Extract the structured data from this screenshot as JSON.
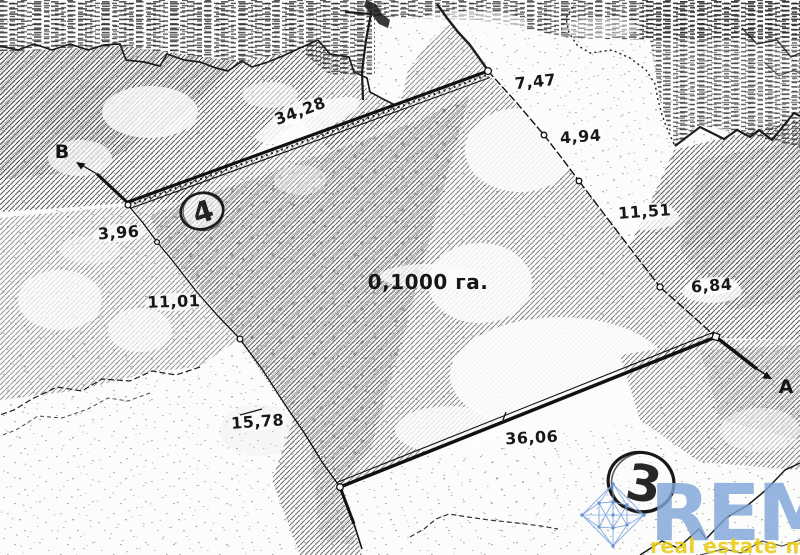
{
  "map": {
    "point_labels": {
      "b": "B",
      "a": "A"
    },
    "parcel_numbers": {
      "parcel_4": "4",
      "parcel_3": "3"
    },
    "area_label": "0,1000 га.",
    "measurements": {
      "top_side": "34,28",
      "right_1": "7,47",
      "right_2": "4,94",
      "right_3": "11,51",
      "right_4": "6,84",
      "left_1": "3,96",
      "left_2": "11,01",
      "left_3": "15,78",
      "bottom_side": "36,06"
    }
  },
  "watermark": {
    "brand": "REM",
    "tagline": "real estate map",
    "brand_color": "#7fa6d8",
    "tagline_color": "#e7cb12",
    "mesh_color": "#7ba4dd",
    "mesh_node_color": "#5d8ecf"
  },
  "ink_color": "#1a1a1a"
}
